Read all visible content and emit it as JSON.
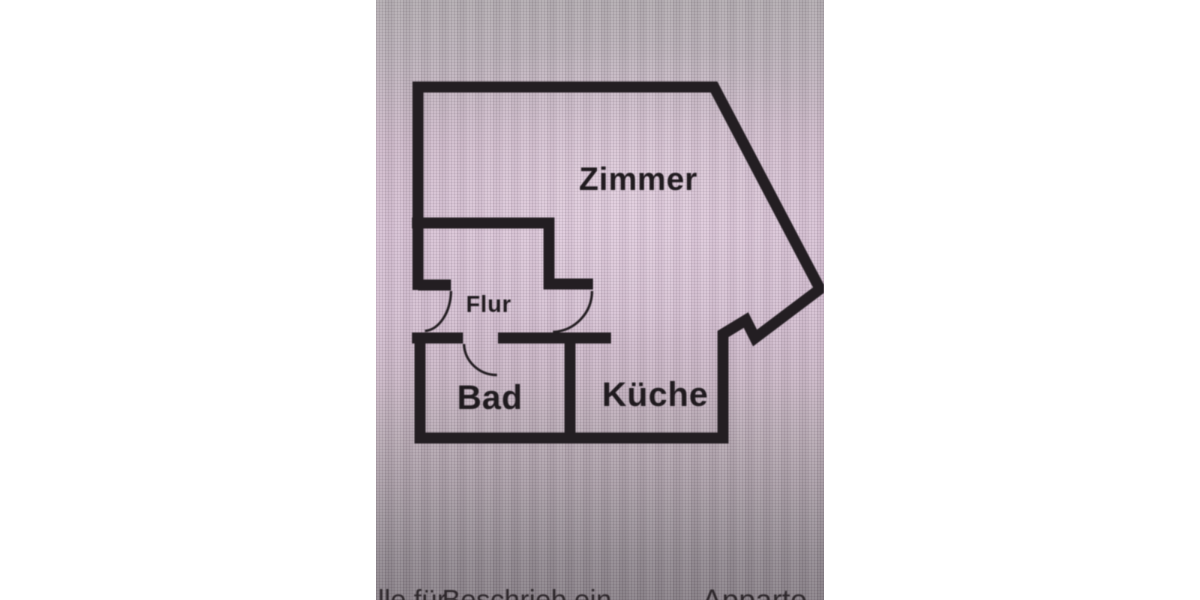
{
  "photo": {
    "background_top_color": "#b2abb0",
    "background_mid_color": "#d6c0d3",
    "background_bottom_color": "#898188",
    "wall_color": "#231e22",
    "label_color": "#201b1f",
    "margin_color": "#ffffff"
  },
  "rooms": [
    {
      "id": "zimmer",
      "label": "Zimmer"
    },
    {
      "id": "flur",
      "label": "Flur"
    },
    {
      "id": "bad",
      "label": "Bad"
    },
    {
      "id": "kueche",
      "label": "Küche"
    }
  ],
  "caption": {
    "fragment_left": "lle für",
    "fragment_mid": "Beschrieb ein",
    "fragment_right": "Apparte"
  }
}
